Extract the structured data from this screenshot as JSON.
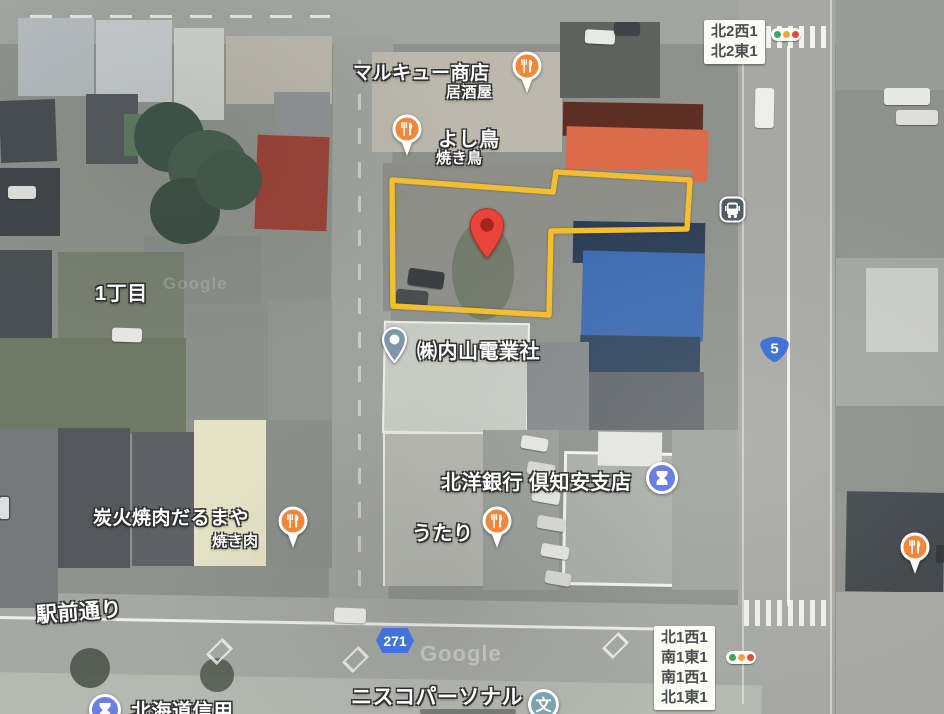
{
  "map": {
    "watermark": "Google"
  },
  "intersections": {
    "top": {
      "line1": "北2西1",
      "line2": "北2東1"
    },
    "bottom": {
      "line1": "北1西1",
      "line2": "南1東1",
      "line3": "南1西1",
      "line4": "北1東1"
    }
  },
  "routes": {
    "national_5": "5",
    "prefectural_271": "271"
  },
  "labels": {
    "district": "1丁目",
    "street": "駅前通り"
  },
  "pois": {
    "marukyu": {
      "name": "マルキュー商店",
      "category": "居酒屋"
    },
    "yoshitori": {
      "name": "よし鳥",
      "category": "焼き鳥"
    },
    "uchiyama": {
      "name": "㈱内山電業社"
    },
    "hokuyo_bank": {
      "name": "北洋銀行 倶知安支店"
    },
    "darumaya": {
      "name": "炭火焼肉だるまや",
      "category": "焼き肉"
    },
    "utari": {
      "name": "うたり"
    },
    "nisco": {
      "name": "ニスコパーソナル"
    },
    "hokkaido_shinkin": {
      "name": "北海道信用"
    }
  },
  "icons": {
    "school_glyph": "文"
  },
  "colors": {
    "parcel_outline": "#F5BE2E",
    "marker_red": "#E8443A",
    "poi_restaurant": "#F0873A",
    "poi_bank": "#6B7EE3",
    "poi_school": "#7BA3B0",
    "poi_business": "#7E96A7",
    "route_shield_blue": "#4173D9",
    "bus_icon_bg": "#4F5D68"
  }
}
